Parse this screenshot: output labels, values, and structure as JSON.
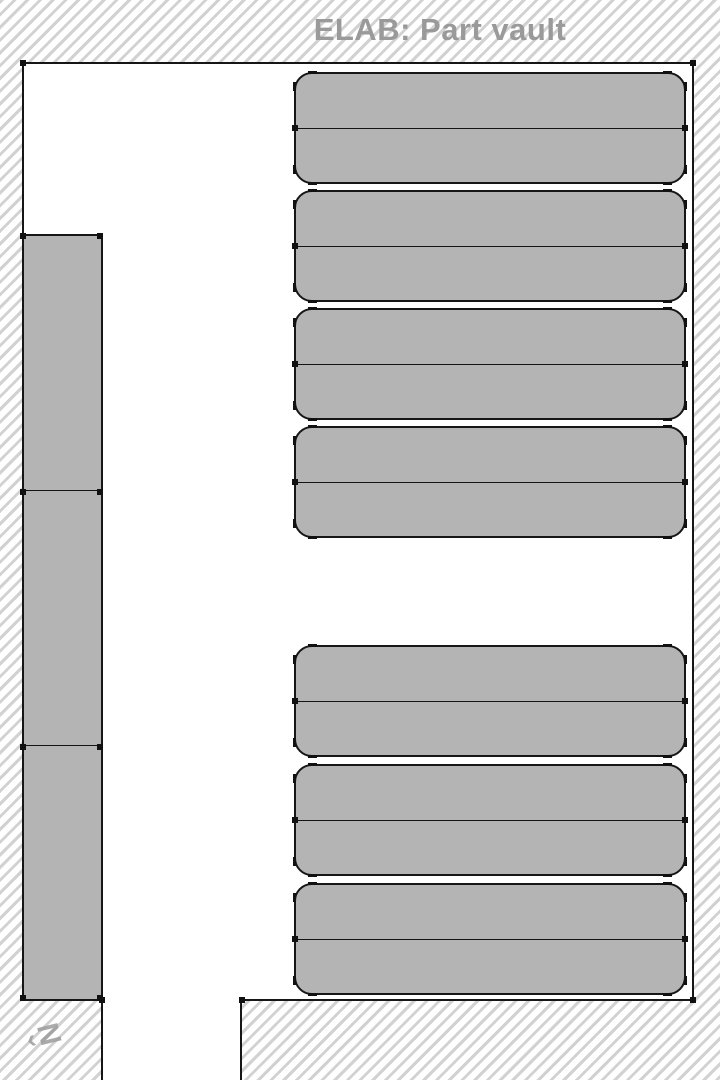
{
  "title": "ELAB: Part vault",
  "map": {
    "kind": "floor-plan",
    "room_name": "Part vault",
    "room": {
      "x": 22,
      "y": 62,
      "width": 672,
      "height": 939
    },
    "door_opening": {
      "side": "bottom",
      "x1": 103,
      "x2": 242
    },
    "corridor": {
      "x": 103,
      "y": 1001,
      "width": 139,
      "height": 79
    },
    "corridor_wall": {
      "x": 101,
      "y": 1001,
      "width": 2,
      "height": 79
    },
    "bottom_right_block": {
      "x": 240,
      "y": 999,
      "width": 454,
      "height": 81
    },
    "left_rack": {
      "x": 22,
      "y": 234,
      "width": 81,
      "height": 767,
      "sections": 3,
      "dividers": [
        254,
        509
      ]
    },
    "shelf_column": {
      "x": 294,
      "width": 392,
      "unit_height": 112,
      "rows_per_unit": 2,
      "unit_tops": [
        72,
        190,
        308,
        426,
        645,
        764,
        883
      ],
      "groups": [
        {
          "name": "upper",
          "units": 4
        },
        {
          "name": "lower",
          "units": 3
        }
      ]
    },
    "wall_markers": [
      [
        23,
        63
      ],
      [
        693,
        63
      ],
      [
        693,
        1000
      ],
      [
        242,
        1000
      ],
      [
        102,
        1000
      ]
    ],
    "north_arrow": {
      "letter": "N",
      "arrowhead": "‹",
      "rotation_deg": -14
    }
  },
  "colors": {
    "wall": "#161616",
    "shelf_fill": "#b4b4b4",
    "shelf_border": "#161616",
    "hatch_stripe": "#d2d2d2",
    "background": "#ffffff",
    "title_text": "#9a9a9a",
    "north_arrow": "#9c9c9c"
  }
}
